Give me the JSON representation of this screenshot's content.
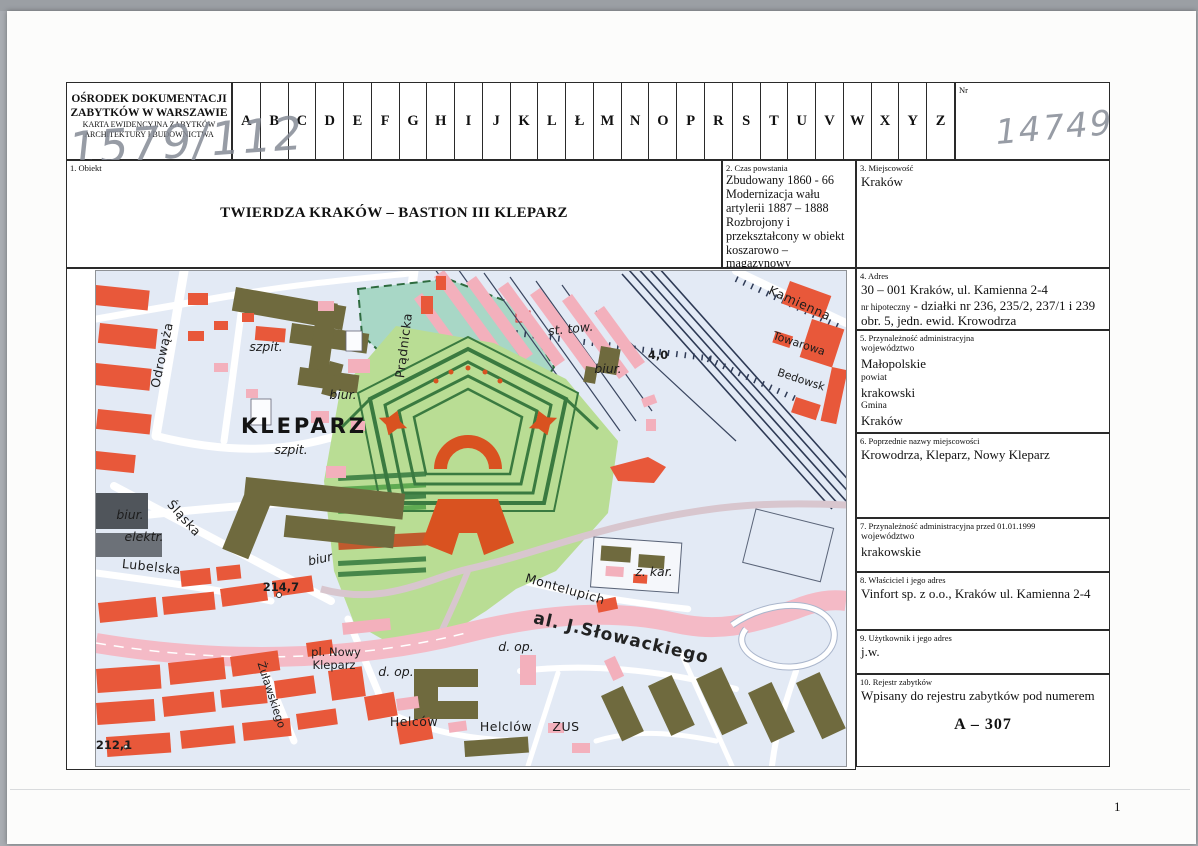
{
  "header": {
    "org_line1": "OŚRODEK DOKUMENTACJI",
    "org_line2": "ZABYTKÓW W WARSZAWIE",
    "org_line3": "KARTA EWIDENCYJNA ZABYTKÓW",
    "org_line4": "ARCHITEKTURY I BUDOWNICTWA",
    "handwritten_ref": "1579/112",
    "letters": [
      "A",
      "B",
      "C",
      "D",
      "E",
      "F",
      "G",
      "H",
      "I",
      "J",
      "K",
      "L",
      "Ł",
      "M",
      "N",
      "O",
      "P",
      "R",
      "S",
      "T",
      "U",
      "V",
      "W",
      "X",
      "Y",
      "Z"
    ],
    "nr_label": "Nr",
    "nr_value": "14749"
  },
  "fields": {
    "obiekt": {
      "label": "1. Obiekt",
      "value": "TWIERDZA KRAKÓW – BASTION III KLEPARZ"
    },
    "czas": {
      "label": "2. Czas powstania",
      "value": "Zbudowany  1860 - 66\nModernizacja wału\nartylerii 1887 – 1888\nRozbrojony i\nprzekształcony w obiekt\nkoszarowo – magazynowy\n1907 - 1908"
    },
    "miejscowosc": {
      "label": "3. Miejscowość",
      "value": "Kraków"
    },
    "adres": {
      "label": "4. Adres",
      "line1": "30 – 001 Kraków, ul. Kamienna 2-4",
      "line2_label": "nr hipoteczny",
      "line2_text": " - działki nr 236, 235/2, 237/1 i 239 obr. 5,  jedn. ewid. Krowodrza"
    },
    "przynaleznosc": {
      "label": "5. Przynależność administracyjna",
      "sub1": "województwo",
      "val1": "Małopolskie",
      "sub2": "powiat",
      "val2": "krakowski",
      "sub3": "Gmina",
      "val3": "Kraków"
    },
    "poprzednie": {
      "label": "6. Poprzednie nazwy miejscowości",
      "value": "Krowodrza, Kleparz, Nowy Kleparz"
    },
    "przed1999": {
      "label": "7. Przynależność administracyjna przed 01.01.1999",
      "sub": "województwo",
      "value": "krakowskie"
    },
    "wlasciciel": {
      "label": "8. Właściciel i jego adres",
      "value": "Vinfort sp. z o.o., Kraków ul. Kamienna 2-4"
    },
    "uzytkownik": {
      "label": "9. Użytkownik i jego adres",
      "value": "j.w."
    },
    "rejestr": {
      "label": "10. Rejestr zabytków",
      "value": "Wpisany do rejestru zabytków pod numerem",
      "number": "A – 307"
    }
  },
  "page": {
    "number": "1"
  },
  "map": {
    "colors": {
      "background": "#e3eaf5",
      "building_red": "#e8583a",
      "building_pink": "#f3b0bc",
      "building_olive": "#6f6a3e",
      "fort_glacis_green": "#b9dd94",
      "rampart_green": "#3a7a40",
      "fort_orange": "#d95220",
      "park_teal": "#a8d7c6",
      "road_pink": "#f4bac6",
      "rail_dark": "#2e3a55"
    },
    "labels": [
      {
        "text": "Odrowąża",
        "x": 70,
        "y": 85,
        "rot": -78,
        "cls": "ml-street"
      },
      {
        "text": "szpit.",
        "x": 170,
        "y": 80,
        "cls": "ml-abbr"
      },
      {
        "text": "szpit.",
        "x": 195,
        "y": 183,
        "cls": "ml-abbr"
      },
      {
        "text": "KLEPARZ",
        "x": 208,
        "y": 162,
        "cls": "ml-district"
      },
      {
        "text": "biur.",
        "x": 247,
        "y": 128,
        "cls": "ml-abbr"
      },
      {
        "text": "Prądnicka",
        "x": 312,
        "y": 75,
        "rot": -83,
        "cls": "ml-street"
      },
      {
        "text": "st. tow.",
        "x": 475,
        "y": 62,
        "rot": -6,
        "cls": "ml-abbr"
      },
      {
        "text": "biur.",
        "x": 512,
        "y": 102,
        "cls": "ml-abbr"
      },
      {
        "text": "4,0",
        "x": 562,
        "y": 88,
        "cls": "ml-num"
      },
      {
        "text": "Kamienna",
        "x": 702,
        "y": 36,
        "rot": 24,
        "cls": "ml-street"
      },
      {
        "text": "Towarowa",
        "x": 702,
        "y": 76,
        "rot": 18,
        "cls": "ml-streetsm"
      },
      {
        "text": "Bedowsk",
        "x": 704,
        "y": 112,
        "rot": 18,
        "cls": "ml-streetsm"
      },
      {
        "text": "Śląska",
        "x": 85,
        "y": 250,
        "rot": 48,
        "cls": "ml-street"
      },
      {
        "text": "biur.",
        "x": 34,
        "y": 248,
        "cls": "ml-abbr"
      },
      {
        "text": "elektr.",
        "x": 48,
        "y": 270,
        "cls": "ml-abbr"
      },
      {
        "text": "Lubelska",
        "x": 55,
        "y": 300,
        "rot": 6,
        "cls": "ml-street"
      },
      {
        "text": "biur",
        "x": 225,
        "y": 292,
        "rot": -12,
        "cls": "ml-abbr"
      },
      {
        "text": "214,7",
        "x": 185,
        "y": 320,
        "cls": "ml-num"
      },
      {
        "text": "Montelupich",
        "x": 468,
        "y": 322,
        "rot": 16,
        "cls": "ml-street"
      },
      {
        "text": "z. kar.",
        "x": 558,
        "y": 305,
        "cls": "ml-abbr"
      },
      {
        "text": "al. J.Słowackiego",
        "x": 524,
        "y": 372,
        "rot": 13,
        "cls": "ml-road"
      },
      {
        "text": "pl. Nowy",
        "x": 240,
        "y": 385,
        "cls": "ml-plsq"
      },
      {
        "text": "Kleparz",
        "x": 238,
        "y": 398,
        "cls": "ml-plsq"
      },
      {
        "text": "d. op.",
        "x": 300,
        "y": 405,
        "cls": "ml-abbr"
      },
      {
        "text": "d. op.",
        "x": 420,
        "y": 380,
        "cls": "ml-abbr"
      },
      {
        "text": "Żuławskiego",
        "x": 172,
        "y": 425,
        "rot": 72,
        "cls": "ml-streetsm"
      },
      {
        "text": "Helców",
        "x": 318,
        "y": 455,
        "cls": "ml-street"
      },
      {
        "text": "Helclów",
        "x": 410,
        "y": 460,
        "cls": "ml-street"
      },
      {
        "text": "ZUS",
        "x": 470,
        "y": 460,
        "cls": "ml-street"
      },
      {
        "text": "212,1",
        "x": 18,
        "y": 478,
        "cls": "ml-num"
      }
    ]
  }
}
